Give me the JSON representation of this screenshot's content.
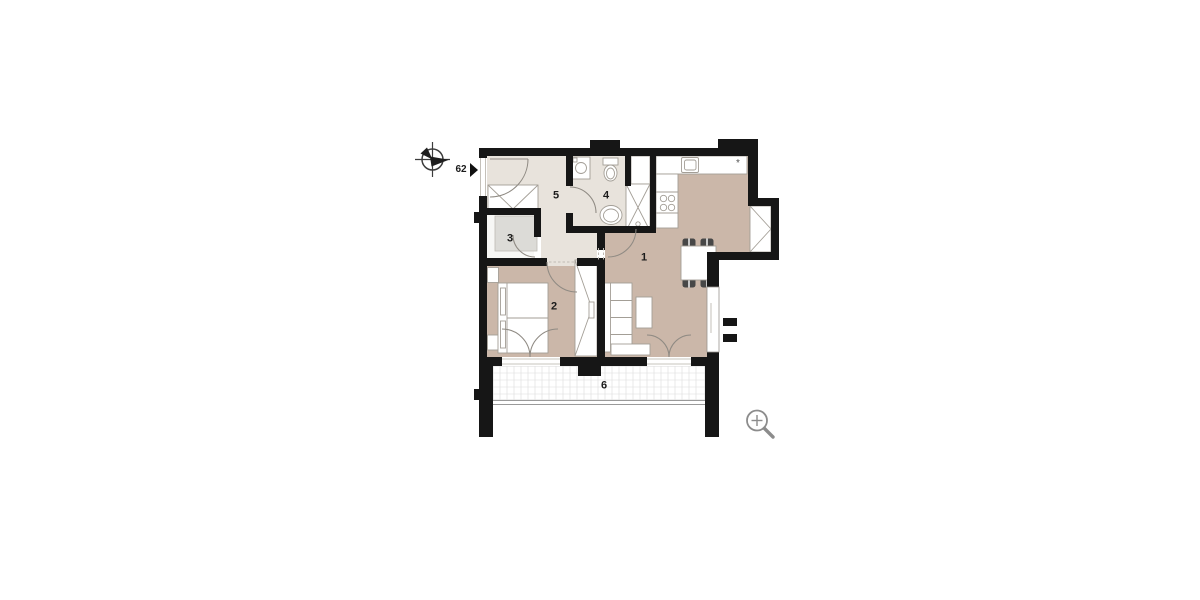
{
  "plan": {
    "unit_number": "62",
    "kitchen_symbol": "*",
    "rooms": [
      {
        "id": "living-kitchen",
        "label": "1"
      },
      {
        "id": "bedroom",
        "label": "2"
      },
      {
        "id": "storage",
        "label": "3"
      },
      {
        "id": "bathroom",
        "label": "4"
      },
      {
        "id": "hall",
        "label": "5"
      },
      {
        "id": "balcony",
        "label": "6"
      }
    ]
  },
  "icons": {
    "compass": "north-compass-icon",
    "entrance_arrow": "entrance-arrow-icon",
    "zoom": "zoom-in-icon"
  },
  "colors": {
    "wall": "#161616",
    "room_warm": "#cbb7a9",
    "room_light": "#e8e3dc",
    "storage_inset": "#dcdbd7",
    "furniture_outline": "#a39e96",
    "door_arc": "#8f8a83",
    "zoom_icon": "#8c8c8c"
  }
}
